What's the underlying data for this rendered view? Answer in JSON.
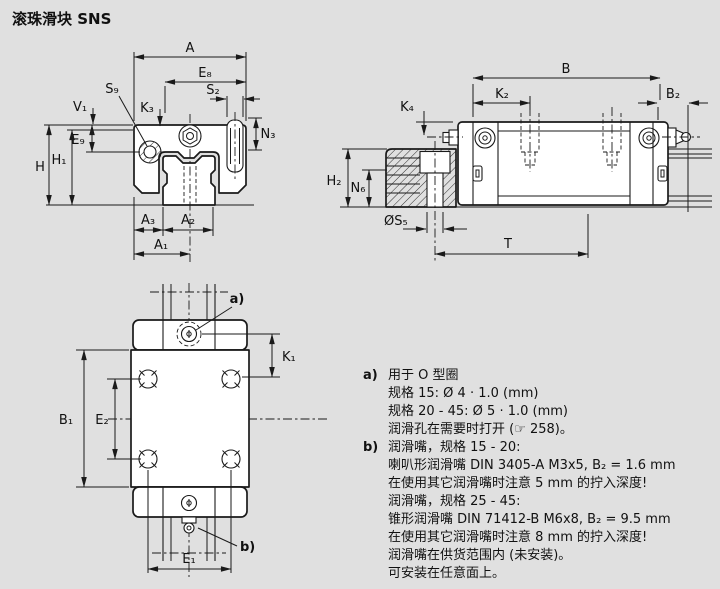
{
  "title": "滚珠滑块 SNS",
  "colors": {
    "background": "#e0e0e0",
    "line": "#1a1a1a",
    "fill": "#ffffff"
  },
  "dims": {
    "front": {
      "A": "A",
      "E8": "E₈",
      "S9": "S₉",
      "V1": "V₁",
      "K3": "K₃",
      "S2": "S₂",
      "N3": "N₃",
      "E9": "E₉",
      "H": "H",
      "H1": "H₁",
      "A3": "A₃",
      "A2": "A₂",
      "A1": "A₁"
    },
    "side": {
      "B": "B",
      "K2": "K₂",
      "B2": "B₂",
      "K4": "K₄",
      "H2": "H₂",
      "N6": "N₆",
      "S5": "ØS₅",
      "T": "T"
    },
    "top": {
      "K1": "K₁",
      "B1": "B₁",
      "E2": "E₂",
      "E1": "E₁",
      "callout_a": "a)",
      "callout_b": "b)"
    }
  },
  "notes": [
    {
      "marker": "a)",
      "text": "用于 O 型圈"
    },
    {
      "marker": "",
      "text": "规格 15: Ø 4 · 1.0 (mm)"
    },
    {
      "marker": "",
      "text": "规格 20 - 45: Ø 5 · 1.0 (mm)"
    },
    {
      "marker": "",
      "text": "润滑孔在需要时打开 (☞ 258)。"
    },
    {
      "marker": "b)",
      "text": "润滑嘴，规格 15 - 20:"
    },
    {
      "marker": "",
      "text": "喇叭形润滑嘴 DIN 3405-A M3x5, B₂ = 1.6 mm"
    },
    {
      "marker": "",
      "text": "在使用其它润滑嘴时注意 5 mm 的拧入深度!"
    },
    {
      "marker": "",
      "text": "润滑嘴，规格 25 - 45:"
    },
    {
      "marker": "",
      "text": "锥形润滑嘴 DIN 71412-B M6x8, B₂ = 9.5 mm"
    },
    {
      "marker": "",
      "text": "在使用其它润滑嘴时注意 8 mm 的拧入深度!"
    },
    {
      "marker": "",
      "text": "润滑嘴在供货范围内 (未安装)。"
    },
    {
      "marker": "",
      "text": "可安装在任意面上。"
    }
  ]
}
